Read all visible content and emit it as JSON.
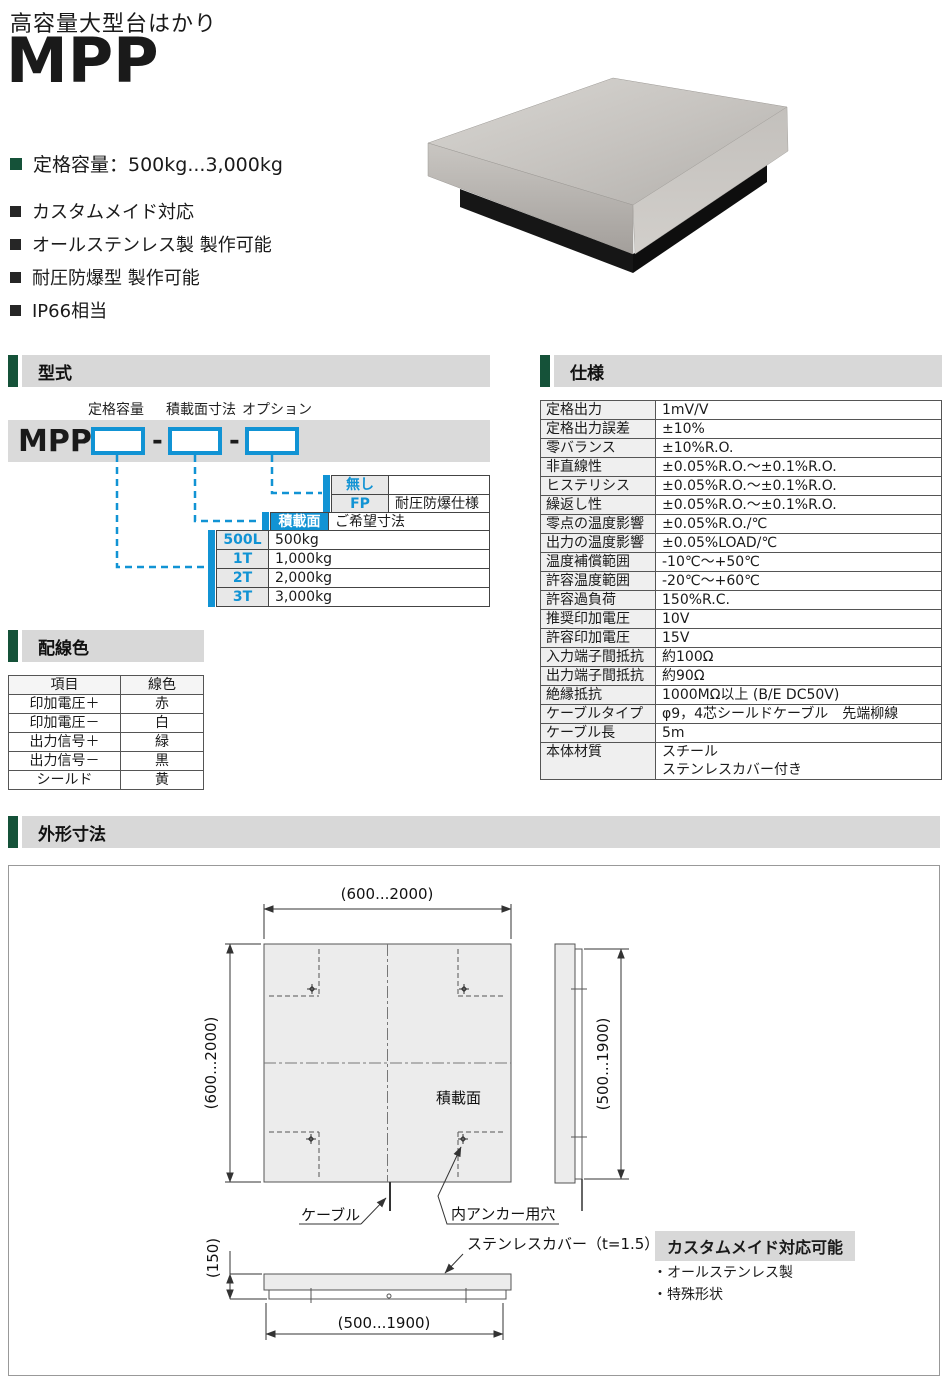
{
  "header": {
    "category": "高容量大型台はかり",
    "model": "MPP"
  },
  "features": {
    "primary": "定格容量：500kg...3,000kg",
    "items": [
      "カスタムメイド対応",
      "オールステンレス製 製作可能",
      "耐圧防爆型 製作可能",
      "IP66相当"
    ]
  },
  "sections": {
    "model": "型式",
    "spec": "仕様",
    "wiring": "配線色",
    "dimensions": "外形寸法"
  },
  "model_diagram": {
    "prefix": "MPP",
    "separator": "-",
    "labels": [
      "定格容量",
      "積載面寸法",
      "オプション"
    ],
    "option_rows": [
      {
        "code": "無し",
        "desc": ""
      },
      {
        "code": "FP",
        "desc": "耐圧防爆仕様"
      }
    ],
    "surface_row": {
      "code": "積載面",
      "desc": "ご希望寸法"
    },
    "capacity_rows": [
      {
        "code": "500L",
        "desc": "500kg"
      },
      {
        "code": "1T",
        "desc": "1,000kg"
      },
      {
        "code": "2T",
        "desc": "2,000kg"
      },
      {
        "code": "3T",
        "desc": "3,000kg"
      }
    ]
  },
  "spec_table": {
    "rows": [
      [
        "定格出力",
        "1mV/V"
      ],
      [
        "定格出力誤差",
        "±10%"
      ],
      [
        "零バランス",
        "±10%R.O."
      ],
      [
        "非直線性",
        "±0.05%R.O.～±0.1%R.O."
      ],
      [
        "ヒステリシス",
        "±0.05%R.O.～±0.1%R.O."
      ],
      [
        "繰返し性",
        "±0.05%R.O.～±0.1%R.O."
      ],
      [
        "零点の温度影響",
        "±0.05%R.O./℃"
      ],
      [
        "出力の温度影響",
        "±0.05%LOAD/℃"
      ],
      [
        "温度補償範囲",
        "-10℃～+50℃"
      ],
      [
        "許容温度範囲",
        "-20℃～+60℃"
      ],
      [
        "許容過負荷",
        "150%R.C."
      ],
      [
        "推奨印加電圧",
        "10V"
      ],
      [
        "許容印加電圧",
        "15V"
      ],
      [
        "入力端子間抵抗",
        "約100Ω"
      ],
      [
        "出力端子間抵抗",
        "約90Ω"
      ],
      [
        "絶縁抵抗",
        "1000MΩ以上 (B/E DC50V)"
      ],
      [
        "ケーブルタイプ",
        "φ9，4芯シールドケーブル　先端柳線"
      ],
      [
        "ケーブル長",
        "5m"
      ],
      [
        "本体材質",
        "スチール\nステンレスカバー付き"
      ]
    ]
  },
  "wiring_table": {
    "headers": [
      "項目",
      "線色"
    ],
    "rows": [
      [
        "印加電圧＋",
        "赤"
      ],
      [
        "印加電圧－",
        "白"
      ],
      [
        "出力信号＋",
        "緑"
      ],
      [
        "出力信号－",
        "黒"
      ],
      [
        "シールド",
        "黄"
      ]
    ]
  },
  "drawing": {
    "dim_top_width": "(600...2000)",
    "dim_left_height": "(600...2000)",
    "dim_side_height": "(500...1900)",
    "dim_bottom_width": "(500...1900)",
    "dim_profile_height": "(150)",
    "label_surface": "積載面",
    "label_cable": "ケーブル",
    "label_anchor_hole": "内アンカー用穴",
    "label_cover": "ステンレスカバー（t=1.5）",
    "custom": {
      "title": "カスタムメイド対応可能",
      "items": [
        "・オールステンレス製",
        "・特殊形状"
      ]
    }
  },
  "colors": {
    "accent_green": "#155239",
    "accent_blue": "#1193d4",
    "band_gray": "#d8d8d8"
  }
}
